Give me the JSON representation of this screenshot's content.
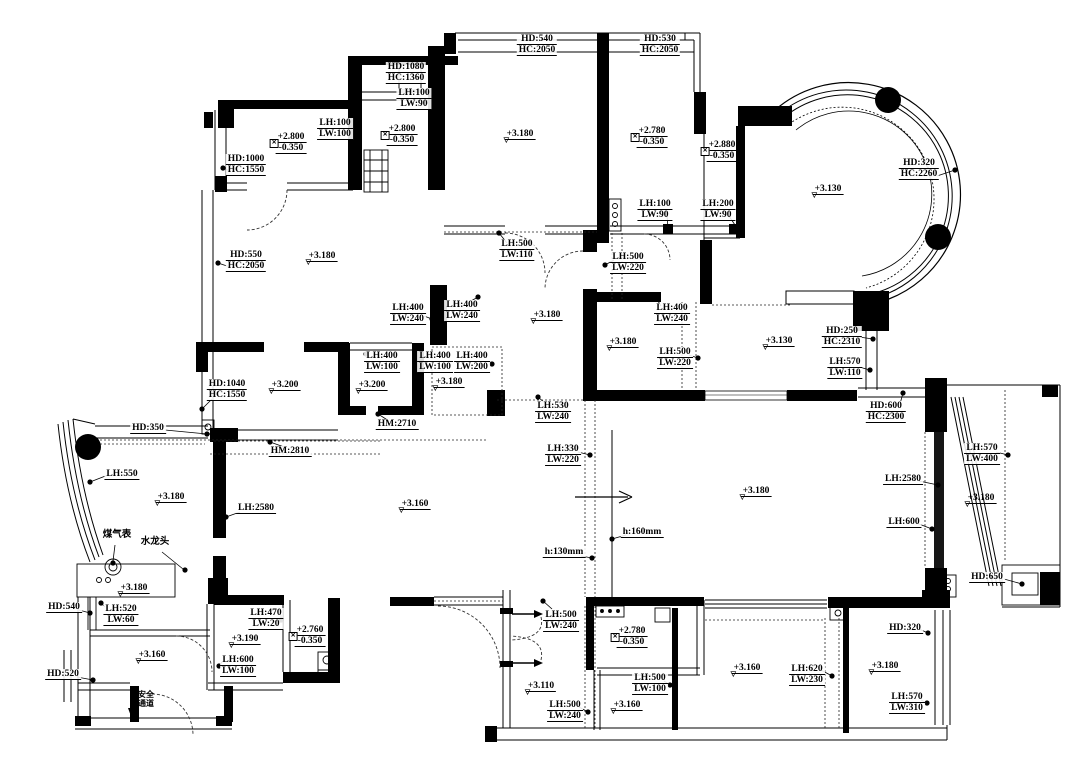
{
  "title": "residential floor plan with ceiling and ledge dimension annotations",
  "colors": {
    "ink": "#000000",
    "paper": "#ffffff",
    "wall_fill": "#000000"
  },
  "icons": {
    "elevation_marker": "▽",
    "box_cross_marker": "✕",
    "direction_arrow": "→"
  },
  "annotations": [
    {
      "x": 406,
      "y": 62,
      "type": "dim2",
      "lines": [
        "HD:1080",
        "HC:1360"
      ]
    },
    {
      "x": 414,
      "y": 88,
      "type": "dim2",
      "lines": [
        "LH:100",
        "LW:90"
      ]
    },
    {
      "x": 537,
      "y": 34,
      "type": "dim2",
      "lines": [
        "HD:540",
        "HC:2050"
      ]
    },
    {
      "x": 660,
      "y": 34,
      "type": "dim2",
      "lines": [
        "HD:530",
        "HC:2050"
      ]
    },
    {
      "x": 335,
      "y": 118,
      "type": "dim2",
      "lines": [
        "LH:100",
        "LW:100"
      ]
    },
    {
      "x": 246,
      "y": 154,
      "type": "dim2",
      "lines": [
        "HD:1000",
        "HC:1550"
      ]
    },
    {
      "x": 290,
      "y": 132,
      "type": "elev2",
      "lines": [
        "+2.800",
        "-0.350"
      ]
    },
    {
      "x": 401,
      "y": 124,
      "type": "elev2",
      "lines": [
        "+2.800",
        "-0.350"
      ]
    },
    {
      "x": 519,
      "y": 129,
      "type": "elev1",
      "lines": [
        "+3.180"
      ]
    },
    {
      "x": 651,
      "y": 126,
      "type": "elev2",
      "lines": [
        "+2.780",
        "-0.350"
      ]
    },
    {
      "x": 721,
      "y": 140,
      "type": "elev2",
      "lines": [
        "+2.880",
        "-0.350"
      ]
    },
    {
      "x": 246,
      "y": 250,
      "type": "dim2",
      "lines": [
        "HD:550",
        "HC:2050"
      ]
    },
    {
      "x": 321,
      "y": 251,
      "type": "elev1",
      "lines": [
        "+3.180"
      ]
    },
    {
      "x": 655,
      "y": 199,
      "type": "dim2",
      "lines": [
        "LH:100",
        "LW:90"
      ]
    },
    {
      "x": 718,
      "y": 199,
      "type": "dim2",
      "lines": [
        "LH:200",
        "LW:90"
      ]
    },
    {
      "x": 517,
      "y": 239,
      "type": "dim2",
      "lines": [
        "LH:500",
        "LW:110"
      ]
    },
    {
      "x": 628,
      "y": 252,
      "type": "dim2",
      "lines": [
        "LH:500",
        "LW:220"
      ]
    },
    {
      "x": 408,
      "y": 303,
      "type": "dim2",
      "lines": [
        "LH:400",
        "LW:240"
      ]
    },
    {
      "x": 462,
      "y": 300,
      "type": "dim2",
      "lines": [
        "LH:400",
        "LW:240"
      ]
    },
    {
      "x": 672,
      "y": 303,
      "type": "dim2",
      "lines": [
        "LH:400",
        "LW:240"
      ]
    },
    {
      "x": 546,
      "y": 310,
      "type": "elev1",
      "lines": [
        "+3.180"
      ]
    },
    {
      "x": 622,
      "y": 337,
      "type": "elev1",
      "lines": [
        "+3.180"
      ]
    },
    {
      "x": 675,
      "y": 347,
      "type": "dim2",
      "lines": [
        "LH:500",
        "LW:220"
      ]
    },
    {
      "x": 778,
      "y": 336,
      "type": "elev1",
      "lines": [
        "+3.130"
      ]
    },
    {
      "x": 842,
      "y": 326,
      "type": "dim2",
      "lines": [
        "HD:250",
        "HC:2310"
      ]
    },
    {
      "x": 845,
      "y": 357,
      "type": "dim2",
      "lines": [
        "LH:570",
        "LW:110"
      ]
    },
    {
      "x": 227,
      "y": 379,
      "type": "dim2",
      "lines": [
        "HD:1040",
        "HC:1550"
      ]
    },
    {
      "x": 284,
      "y": 380,
      "type": "elev1",
      "lines": [
        "+3.200"
      ]
    },
    {
      "x": 382,
      "y": 351,
      "type": "dim2",
      "lines": [
        "LH:400",
        "LW:100"
      ]
    },
    {
      "x": 371,
      "y": 380,
      "type": "elev1",
      "lines": [
        "+3.200"
      ]
    },
    {
      "x": 435,
      "y": 351,
      "type": "dim2",
      "lines": [
        "LH:400",
        "LW:100"
      ]
    },
    {
      "x": 472,
      "y": 351,
      "type": "dim2",
      "lines": [
        "LH:400",
        "LW:200"
      ]
    },
    {
      "x": 448,
      "y": 377,
      "type": "elev1",
      "lines": [
        "+3.180"
      ]
    },
    {
      "x": 397,
      "y": 419,
      "type": "dim1",
      "lines": [
        "HM:2710"
      ]
    },
    {
      "x": 290,
      "y": 446,
      "type": "dim1",
      "lines": [
        "HM:2810"
      ]
    },
    {
      "x": 553,
      "y": 401,
      "type": "dim2",
      "lines": [
        "LH:530",
        "LW:240"
      ]
    },
    {
      "x": 563,
      "y": 444,
      "type": "dim2",
      "lines": [
        "LH:330",
        "LW:220"
      ]
    },
    {
      "x": 642,
      "y": 527,
      "type": "dim1",
      "lines": [
        "h:160mm"
      ]
    },
    {
      "x": 564,
      "y": 547,
      "type": "dim1",
      "lines": [
        "h:130mm"
      ]
    },
    {
      "x": 919,
      "y": 158,
      "type": "dim2",
      "lines": [
        "HD:320",
        "HC:2260"
      ]
    },
    {
      "x": 827,
      "y": 184,
      "type": "elev1",
      "lines": [
        "+3.130"
      ]
    },
    {
      "x": 148,
      "y": 423,
      "type": "dim1",
      "lines": [
        "HD:350"
      ]
    },
    {
      "x": 122,
      "y": 469,
      "type": "dim1",
      "lines": [
        "LH:550"
      ]
    },
    {
      "x": 170,
      "y": 492,
      "type": "elev1",
      "lines": [
        "+3.180"
      ]
    },
    {
      "x": 117,
      "y": 530,
      "type": "text",
      "lines": [
        "煤气表"
      ]
    },
    {
      "x": 155,
      "y": 537,
      "type": "text",
      "lines": [
        "水龙头"
      ]
    },
    {
      "x": 256,
      "y": 503,
      "type": "dim1",
      "lines": [
        "LH:2580"
      ]
    },
    {
      "x": 414,
      "y": 499,
      "type": "elev1",
      "lines": [
        "+3.160"
      ]
    },
    {
      "x": 133,
      "y": 583,
      "type": "elev1",
      "lines": [
        "+3.180"
      ]
    },
    {
      "x": 64,
      "y": 602,
      "type": "dim1",
      "lines": [
        "HD:540"
      ]
    },
    {
      "x": 121,
      "y": 604,
      "type": "dim2",
      "lines": [
        "LH:520",
        "LW:60"
      ]
    },
    {
      "x": 63,
      "y": 669,
      "type": "dim1",
      "lines": [
        "HD:520"
      ]
    },
    {
      "x": 151,
      "y": 650,
      "type": "elev1",
      "lines": [
        "+3.160"
      ]
    },
    {
      "x": 146,
      "y": 690,
      "type": "text2",
      "lines": [
        "安全",
        "通道"
      ]
    },
    {
      "x": 266,
      "y": 608,
      "type": "dim2",
      "lines": [
        "LH:470",
        "LW:20"
      ]
    },
    {
      "x": 244,
      "y": 634,
      "type": "elev1",
      "lines": [
        "+3.190"
      ]
    },
    {
      "x": 238,
      "y": 655,
      "type": "dim2",
      "lines": [
        "LH:600",
        "LW:100"
      ]
    },
    {
      "x": 309,
      "y": 625,
      "type": "elev2",
      "lines": [
        "+2.760",
        "-0.350"
      ]
    },
    {
      "x": 561,
      "y": 610,
      "type": "dim2",
      "lines": [
        "LH:500",
        "LW:240"
      ]
    },
    {
      "x": 631,
      "y": 626,
      "type": "elev2",
      "lines": [
        "+2.780",
        "-0.350"
      ]
    },
    {
      "x": 540,
      "y": 681,
      "type": "elev1",
      "lines": [
        "+3.110"
      ]
    },
    {
      "x": 565,
      "y": 700,
      "type": "dim2",
      "lines": [
        "LH:500",
        "LW:240"
      ]
    },
    {
      "x": 650,
      "y": 673,
      "type": "dim2",
      "lines": [
        "LH:500",
        "LW:100"
      ]
    },
    {
      "x": 626,
      "y": 700,
      "type": "elev1",
      "lines": [
        "+3.160"
      ]
    },
    {
      "x": 746,
      "y": 663,
      "type": "elev1",
      "lines": [
        "+3.160"
      ]
    },
    {
      "x": 807,
      "y": 664,
      "type": "dim2",
      "lines": [
        "LH:620",
        "LW:230"
      ]
    },
    {
      "x": 905,
      "y": 623,
      "type": "dim1",
      "lines": [
        "HD:320"
      ]
    },
    {
      "x": 884,
      "y": 661,
      "type": "elev1",
      "lines": [
        "+3.180"
      ]
    },
    {
      "x": 907,
      "y": 692,
      "type": "dim2",
      "lines": [
        "LH:570",
        "LW:310"
      ]
    },
    {
      "x": 886,
      "y": 401,
      "type": "dim2",
      "lines": [
        "HD:600",
        "HC:2300"
      ]
    },
    {
      "x": 982,
      "y": 443,
      "type": "dim2",
      "lines": [
        "LH:570",
        "LW:400"
      ]
    },
    {
      "x": 903,
      "y": 474,
      "type": "dim1",
      "lines": [
        "LH:2580"
      ]
    },
    {
      "x": 980,
      "y": 493,
      "type": "elev1",
      "lines": [
        "+3.180"
      ]
    },
    {
      "x": 755,
      "y": 486,
      "type": "elev1",
      "lines": [
        "+3.180"
      ]
    },
    {
      "x": 904,
      "y": 517,
      "type": "dim1",
      "lines": [
        "LH:600"
      ]
    },
    {
      "x": 987,
      "y": 572,
      "type": "dim1",
      "lines": [
        "HD:650"
      ]
    }
  ],
  "drawing": {
    "leader_dots": [
      [
        429,
        102
      ],
      [
        352,
        132
      ],
      [
        223,
        168
      ],
      [
        218,
        263
      ],
      [
        207,
        434
      ],
      [
        90,
        482
      ],
      [
        270,
        442
      ],
      [
        378,
        414
      ],
      [
        202,
        409
      ],
      [
        366,
        354
      ],
      [
        420,
        348
      ],
      [
        492,
        364
      ],
      [
        432,
        319
      ],
      [
        478,
        297
      ],
      [
        499,
        233
      ],
      [
        605,
        265
      ],
      [
        655,
        296
      ],
      [
        698,
        358
      ],
      [
        668,
        228
      ],
      [
        737,
        228
      ],
      [
        538,
        397
      ],
      [
        590,
        455
      ],
      [
        612,
        539
      ],
      [
        592,
        558
      ],
      [
        873,
        339
      ],
      [
        870,
        370
      ],
      [
        955,
        170
      ],
      [
        903,
        393
      ],
      [
        938,
        485
      ],
      [
        932,
        529
      ],
      [
        1008,
        455
      ],
      [
        1022,
        584
      ],
      [
        226,
        517
      ],
      [
        90,
        613
      ],
      [
        101,
        603
      ],
      [
        93,
        680
      ],
      [
        281,
        620
      ],
      [
        219,
        666
      ],
      [
        543,
        601
      ],
      [
        588,
        712
      ],
      [
        670,
        685
      ],
      [
        832,
        676
      ],
      [
        928,
        633
      ],
      [
        927,
        703
      ],
      [
        113,
        563
      ],
      [
        185,
        570
      ]
    ],
    "leader_lines": [
      [
        432,
        106,
        429,
        102
      ],
      [
        349,
        127,
        352,
        132
      ],
      [
        230,
        171,
        223,
        168
      ],
      [
        230,
        267,
        218,
        263
      ],
      [
        165,
        430,
        207,
        434
      ],
      [
        108,
        475,
        90,
        482
      ],
      [
        287,
        448,
        270,
        442
      ],
      [
        389,
        421,
        378,
        414
      ],
      [
        212,
        399,
        202,
        409
      ],
      [
        937,
        176,
        955,
        170
      ],
      [
        900,
        404,
        903,
        393
      ],
      [
        919,
        481,
        938,
        485
      ],
      [
        919,
        524,
        932,
        529
      ],
      [
        996,
        452,
        1008,
        455
      ],
      [
        1004,
        579,
        1022,
        584
      ],
      [
        859,
        337,
        873,
        339
      ],
      [
        859,
        367,
        870,
        370
      ],
      [
        919,
        629,
        928,
        633
      ],
      [
        921,
        700,
        927,
        703
      ],
      [
        821,
        670,
        832,
        676
      ],
      [
        664,
        681,
        670,
        685
      ],
      [
        579,
        707,
        588,
        712
      ],
      [
        552,
        609,
        543,
        601
      ],
      [
        281,
        615,
        281,
        620
      ],
      [
        222,
        662,
        219,
        666
      ],
      [
        105,
        607,
        101,
        603
      ],
      [
        79,
        610,
        90,
        613
      ],
      [
        77,
        677,
        93,
        680
      ],
      [
        626,
        535,
        612,
        539
      ],
      [
        581,
        556,
        592,
        558
      ],
      [
        578,
        452,
        590,
        455
      ],
      [
        546,
        404,
        538,
        397
      ],
      [
        507,
        243,
        499,
        233
      ],
      [
        614,
        260,
        605,
        265
      ],
      [
        667,
        216,
        668,
        228
      ],
      [
        729,
        216,
        737,
        228
      ],
      [
        661,
        306,
        655,
        296
      ],
      [
        689,
        355,
        698,
        358
      ],
      [
        240,
        512,
        226,
        517
      ],
      [
        424,
        316,
        432,
        319
      ],
      [
        471,
        301,
        478,
        297
      ],
      [
        115,
        545,
        113,
        561
      ],
      [
        162,
        552,
        183,
        569
      ]
    ]
  }
}
